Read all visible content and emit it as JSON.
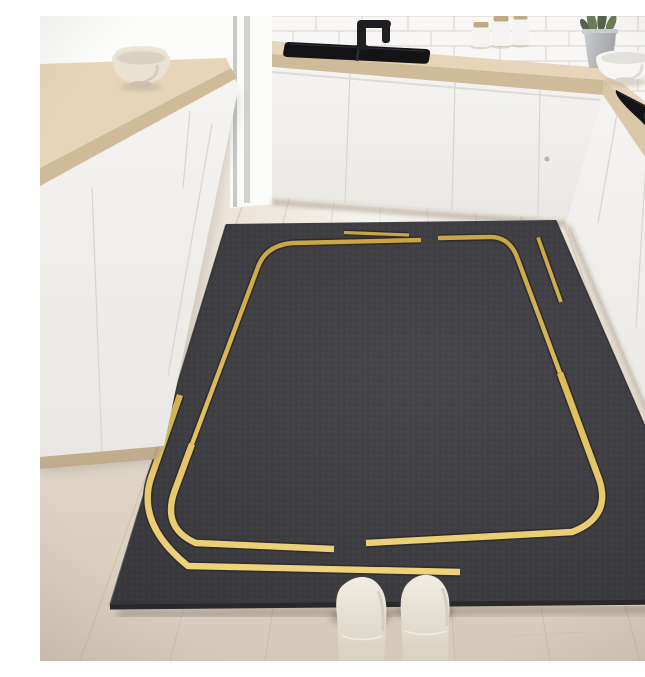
{
  "image": {
    "kind": "product-photo",
    "subject": "anti-fatigue kitchen mat",
    "setting": "modern white kitchen, first-person view looking down at mat",
    "mat": {
      "shape": "large rectangle seen in perspective",
      "base_color_name": "charcoal gray",
      "pattern": "staggered open rounded-rectangle gold line frame with short accent dashes",
      "line_color_name": "gold"
    },
    "objects": [
      "wood-laminate-floor",
      "subway-tile-backsplash",
      "window",
      "sink-counter",
      "black-sink",
      "black-faucet",
      "white-cabinet-fronts",
      "right-counter-run",
      "black-cooktop",
      "cooktop-knobs",
      "storage-canisters",
      "plant-pot",
      "plant",
      "white-bowl-on-counter",
      "kitchen-island",
      "island-wood-countertop",
      "beige-bowl-on-island",
      "kitchen-mat",
      "gold-frame-lines",
      "person-feet-in-socks"
    ]
  },
  "palette": {
    "floor_a": "#efe8de",
    "floor_b": "#d5c9ba",
    "plank": "#c3b6a4",
    "tile": "#f8f7f5",
    "grout": "#e4e1dc",
    "wood_a": "#e6d5b8",
    "wood_b": "#cfbb9a",
    "wood_c": "#bfa987",
    "cab_a": "#f5f4f2",
    "cab_b": "#e9e7e3",
    "seam": "#d9d6d0",
    "window_a": "#fbfbfa",
    "frame": "#c9c8c6",
    "sink": "#141416",
    "metal": "#1f1f22",
    "rug_a": "#47464b",
    "rug_b": "#38373b",
    "rug_edge": "#29282b",
    "gold_a": "#c7a243",
    "gold_b": "#debc58",
    "gold_c": "#f1d680",
    "groove": "#2b2b2e",
    "sock_a": "#f1ece2",
    "sock_b": "#d8d1c2",
    "pot_a": "#c9cbcc",
    "pot_b": "#a2a4a6",
    "leaf": "#6a7a5b",
    "leaf_d": "#566349",
    "bowl_w": "#f7f6f3",
    "bowl_b": "#e9e2d3",
    "shadow": "#3a352e"
  }
}
